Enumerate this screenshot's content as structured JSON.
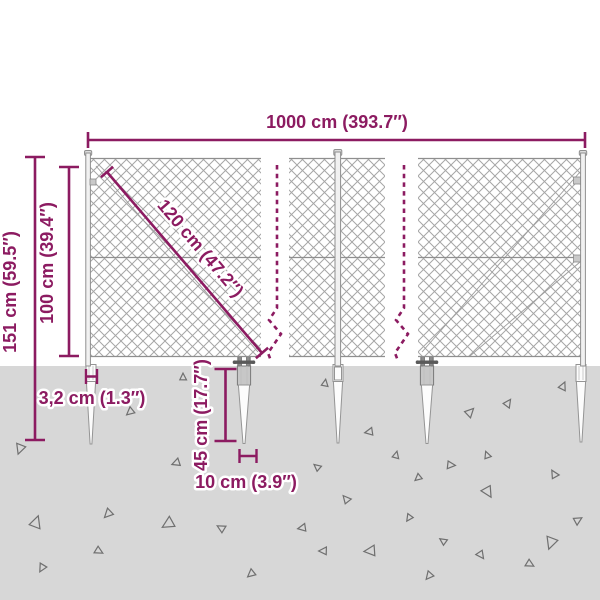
{
  "labels": {
    "total_width": "1000 cm (393.7″)",
    "overall_height": "151 cm (59.5″)",
    "fence_height": "100 cm (39.4″)",
    "mesh_diagonal": "120 cm (47.2″)",
    "post_thickness": "3,2 cm (1.3″)",
    "spike_depth": "45 cm (17.7″)",
    "spike_anchor_width": "10 cm (3.9″)"
  },
  "colors": {
    "accent": "#8c1b61",
    "ground": "#d7d7d7",
    "frame": "#8f8f8f",
    "mesh": "#a6a6a6",
    "tri": "#6f6f6f"
  },
  "ground": {
    "triangles": [
      [
        20,
        449,
        10,
        200
      ],
      [
        36,
        522,
        12,
        20
      ],
      [
        42,
        568,
        8,
        210
      ],
      [
        99,
        551,
        8,
        120
      ],
      [
        108,
        514,
        9,
        225
      ],
      [
        130,
        412,
        8,
        230
      ],
      [
        168,
        524,
        12,
        240
      ],
      [
        176,
        463,
        8,
        250
      ],
      [
        183,
        377,
        7,
        0
      ],
      [
        221,
        528,
        8,
        300
      ],
      [
        251,
        574,
        8,
        230
      ],
      [
        302,
        528,
        8,
        260
      ],
      [
        317,
        467,
        7,
        310
      ],
      [
        323,
        551,
        8,
        270
      ],
      [
        325,
        383,
        7,
        10
      ],
      [
        346,
        499,
        8,
        320
      ],
      [
        369,
        432,
        8,
        260
      ],
      [
        370,
        551,
        11,
        265
      ],
      [
        396,
        455,
        7,
        15
      ],
      [
        409,
        518,
        7,
        215
      ],
      [
        418,
        478,
        7,
        230
      ],
      [
        429,
        576,
        8,
        220
      ],
      [
        443,
        541,
        7,
        305
      ],
      [
        451,
        465,
        8,
        95
      ],
      [
        470,
        412,
        9,
        45
      ],
      [
        481,
        555,
        8,
        145
      ],
      [
        487,
        455,
        7,
        340
      ],
      [
        488,
        492,
        11,
        150
      ],
      [
        508,
        403,
        8,
        35
      ],
      [
        530,
        564,
        8,
        120
      ],
      [
        551,
        543,
        12,
        200
      ],
      [
        554,
        474,
        8,
        330
      ],
      [
        563,
        386,
        8,
        25
      ],
      [
        578,
        520,
        8,
        60
      ]
    ]
  }
}
